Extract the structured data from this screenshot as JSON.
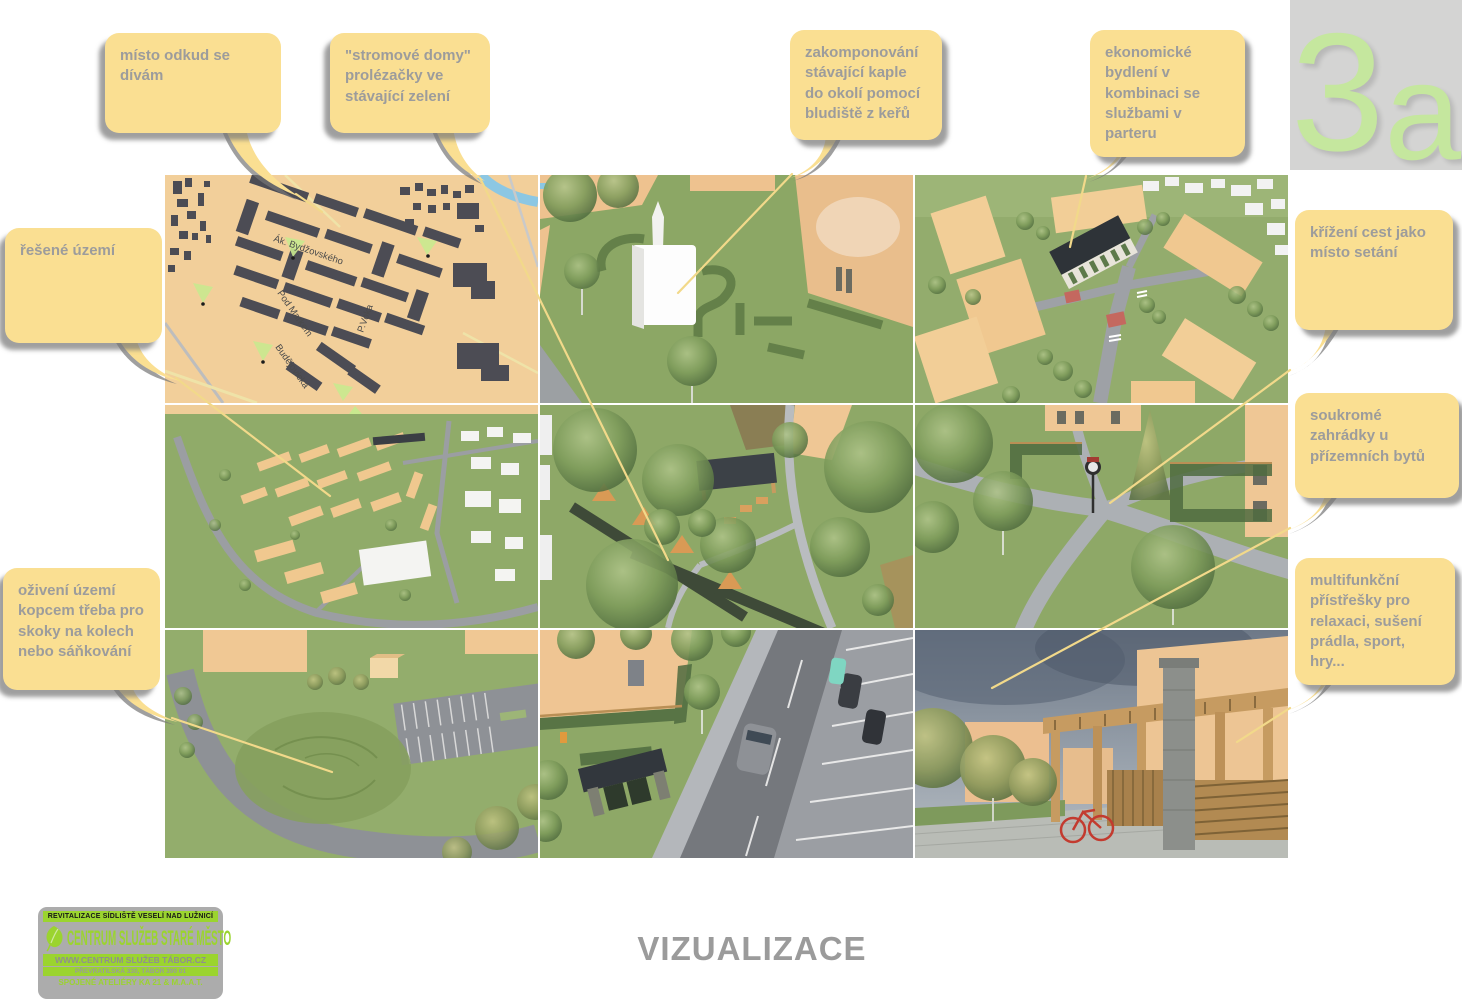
{
  "sheet": {
    "number_big": "3",
    "number_small": "a",
    "footer_title": "VIZUALIZACE"
  },
  "callouts": {
    "viewpoint": "místo odkud se dívám",
    "tree_houses": "\"stromové domy\" prolézačky ve stávající zelení",
    "chapel": "zakomponování stávající kaple do okolí pomocí bludiště z keřů",
    "economic": "ekonomické bydlení v kombinaci se službami v parteru",
    "area": "řešené území",
    "crossing": "křížení cest jako místo setání",
    "gardens": "soukromé zahrádky u přízemních bytů",
    "hill": "oživení území kopcem třeba pro skoky na kolech nebo sáňkování",
    "shelters": "multifunkční přístřešky pro relaxaci, sušení prádla, sport, hry..."
  },
  "map": {
    "streets": {
      "s1": "Ák. Bydžovského",
      "s2": "Pod Markem",
      "s3": "P.Voka",
      "s4": "Budějovická"
    }
  },
  "logo": {
    "line1": "REVITALIZACE SÍDLIŠTĚ VESELÍ NAD LUŽNICÍ",
    "title": "CENTRUM SLUŽEB STARÉ MĚSTO",
    "web": "WWW.CENTRUM SLUŽEB TÁBOR.CZ",
    "address": "PŘEVRATILSKÁ 330, TÁBOR 390 01",
    "studios": "SPOJENÉ ATELIÉRY KA 21 & M.A.A.T."
  },
  "colors": {
    "bubble": "#FADF92",
    "bubble_text": "#9C9C9C",
    "accent_green": "#9BD42F",
    "sheet_green": "#C5E79E"
  }
}
